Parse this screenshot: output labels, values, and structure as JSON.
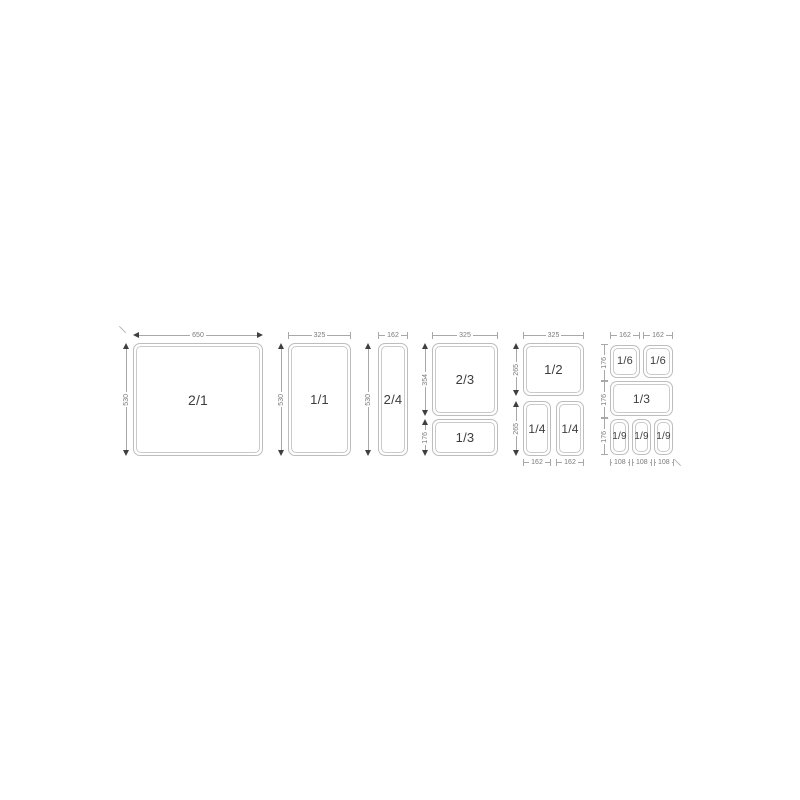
{
  "figure": {
    "description": "Gastronorm container size diagram",
    "colors": {
      "background": "#ffffff",
      "pan_border": "#bdbdbd",
      "dimension_line": "#a8a8a8",
      "dimension_text": "#7a7a7a",
      "pan_text": "#3d3d3d",
      "arrow": "#3f3f3f"
    },
    "groups": [
      {
        "name": "gn-2-1",
        "pans": [
          "2/1"
        ],
        "top_dims": [
          "650"
        ],
        "side_dims": [
          "530"
        ]
      },
      {
        "name": "gn-1-1",
        "pans": [
          "1/1"
        ],
        "top_dims": [
          "325"
        ],
        "side_dims": [
          "530"
        ]
      },
      {
        "name": "gn-2-4",
        "pans": [
          "2/4"
        ],
        "top_dims": [
          "162"
        ],
        "side_dims": [
          "530"
        ]
      },
      {
        "name": "gn-2-3-plus-1-3",
        "pans": [
          "2/3",
          "1/3"
        ],
        "top_dims": [
          "325"
        ],
        "side_dims": [
          "354",
          "176"
        ]
      },
      {
        "name": "gn-1-2-plus-1-4",
        "pans": [
          "1/2",
          "1/4",
          "1/4"
        ],
        "top_dims": [
          "325"
        ],
        "side_dims": [
          "265",
          "265"
        ],
        "bottom_dims": [
          "162",
          "162"
        ]
      },
      {
        "name": "gn-1-6-1-3-1-9",
        "pans": [
          "1/6",
          "1/6",
          "1/3",
          "1/9",
          "1/9",
          "1/9"
        ],
        "top_dims": [
          "162",
          "162"
        ],
        "side_dims": [
          "176",
          "176",
          "176"
        ],
        "bottom_dims": [
          "108",
          "108",
          "108"
        ]
      }
    ]
  }
}
